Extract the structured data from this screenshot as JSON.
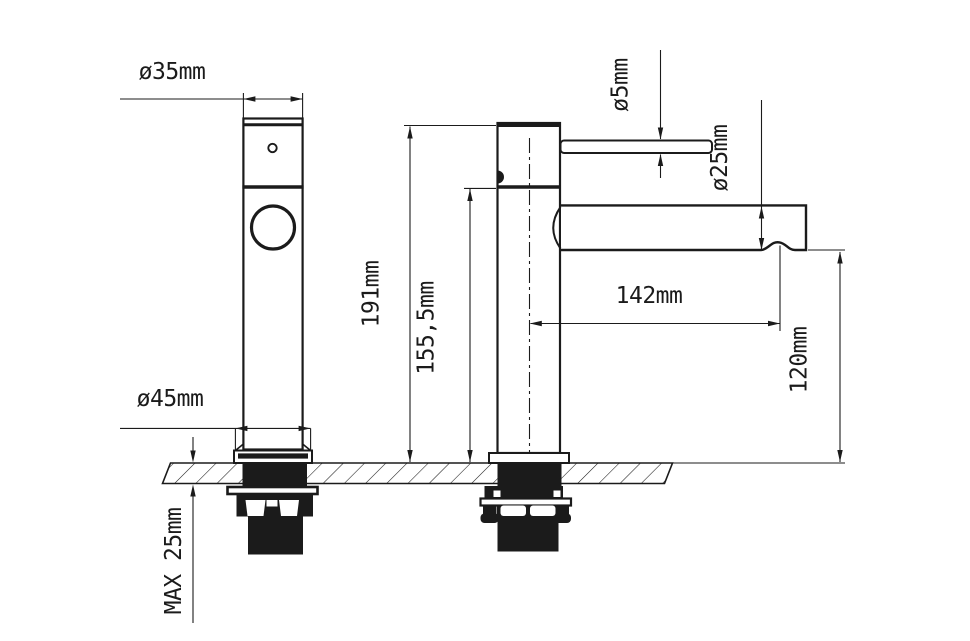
{
  "drawing": {
    "description": "Basin mixer tap technical drawing, front and side views with installation dimensions",
    "colors": {
      "line": "#1b1b1b",
      "background": "#ffffff"
    },
    "dimensions": {
      "spout_top_width": "ø35mm",
      "base_width": "ø45mm",
      "handle_rod_diameter": "ø5mm",
      "spout_tube_diameter": "ø25mm",
      "total_height": "191mm",
      "body_height": "155,5mm",
      "spout_reach": "142mm",
      "outlet_height": "120mm",
      "max_deck_thickness": "MAX 25mm"
    }
  }
}
